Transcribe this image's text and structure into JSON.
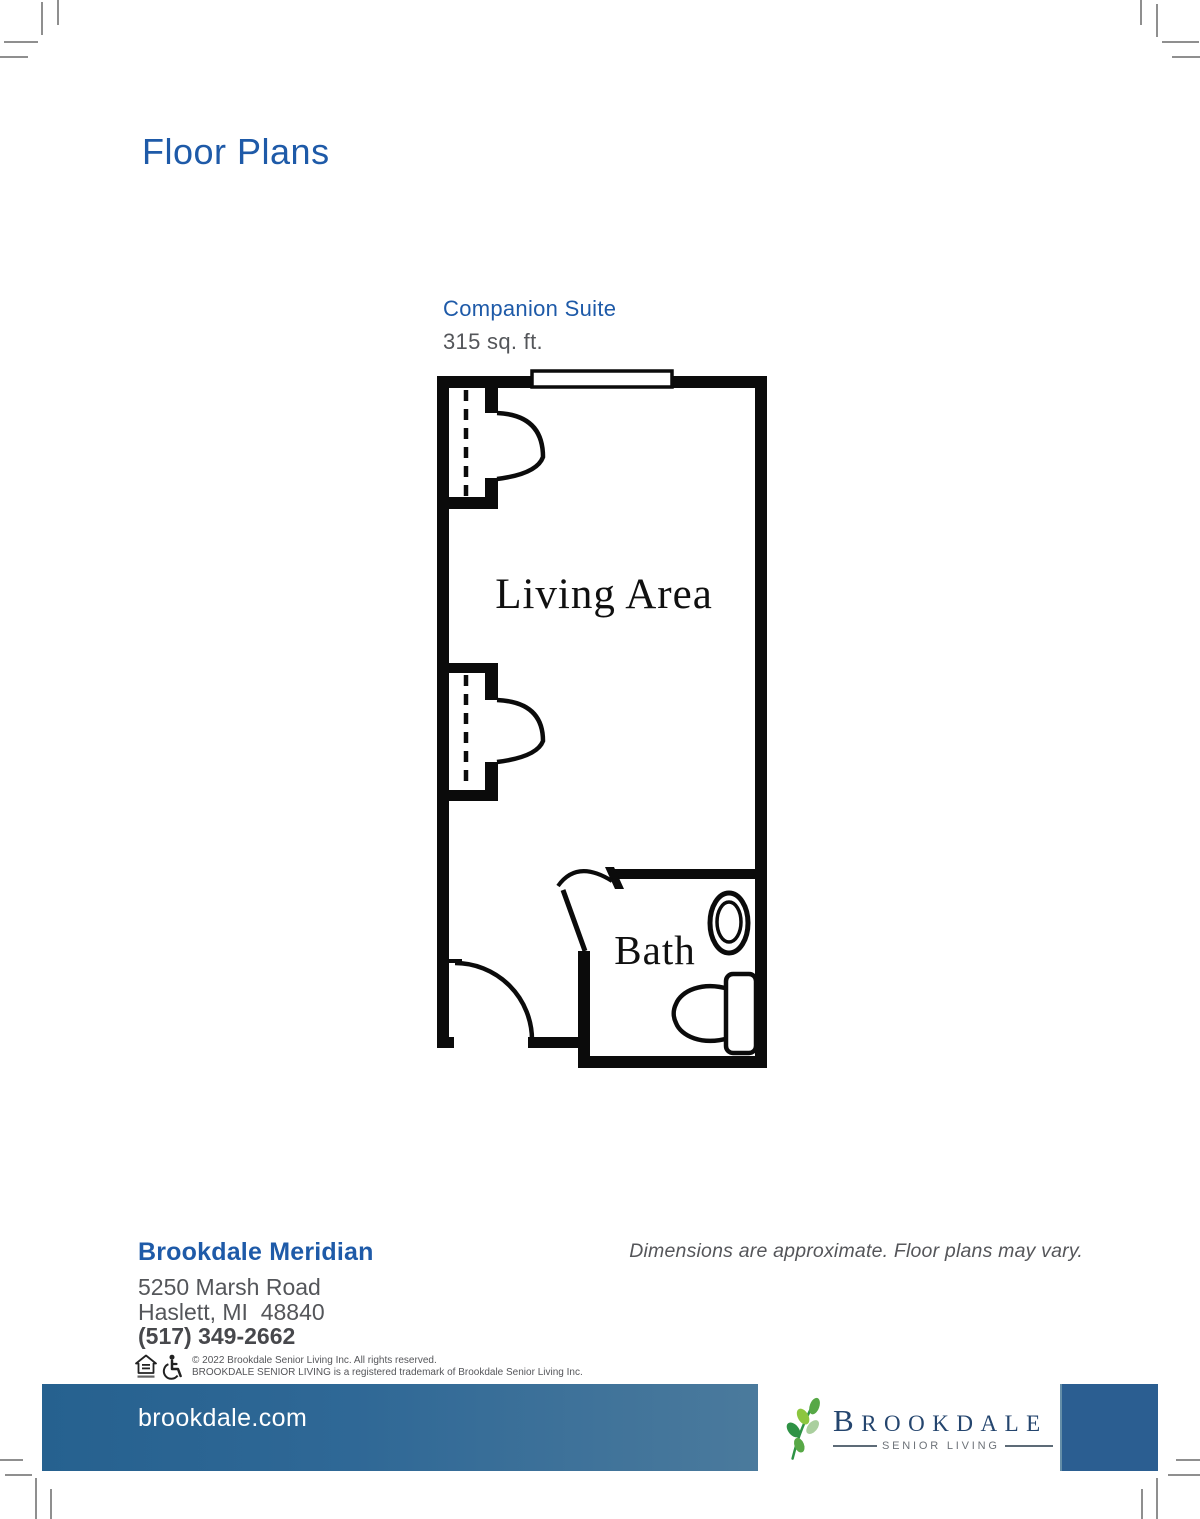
{
  "page": {
    "title": "Floor Plans"
  },
  "plan": {
    "name": "Companion Suite",
    "area": "315 sq. ft.",
    "living_area_label": "Living Area",
    "bath_label": "Bath"
  },
  "community": {
    "name": "Brookdale Meridian",
    "address_line1": "5250 Marsh Road",
    "address_line2": "Haslett, MI  48840",
    "phone": "(517) 349-2662"
  },
  "disclaimer": "Dimensions are approximate. Floor plans may vary.",
  "legal": {
    "line1": "© 2022 Brookdale Senior Living Inc. All rights reserved.",
    "line2": "BROOKDALE SENIOR LIVING is a registered trademark of Brookdale Senior Living Inc.",
    "icons": [
      "equal-housing-icon",
      "wheelchair-icon"
    ]
  },
  "footer": {
    "website": "brookdale.com",
    "logo": {
      "wordmark": "BROOKDALE",
      "tagline": "SENIOR LIVING"
    }
  },
  "colors": {
    "accent_blue": "#1E5AA8",
    "text_gray": "#54565A",
    "plan_line_black": "#0B0B0B",
    "bar_gradient_start": "#26618F",
    "bar_gradient_end": "#6C95AB",
    "bar_end_block": "#2B5E91",
    "logo_navy": "#24456E",
    "logo_gray": "#6D7278",
    "leaf_green_dark": "#2E9245",
    "leaf_green_mid": "#57A846",
    "leaf_green_light": "#8CC63F",
    "leaf_green_pale": "#AACF9E"
  }
}
